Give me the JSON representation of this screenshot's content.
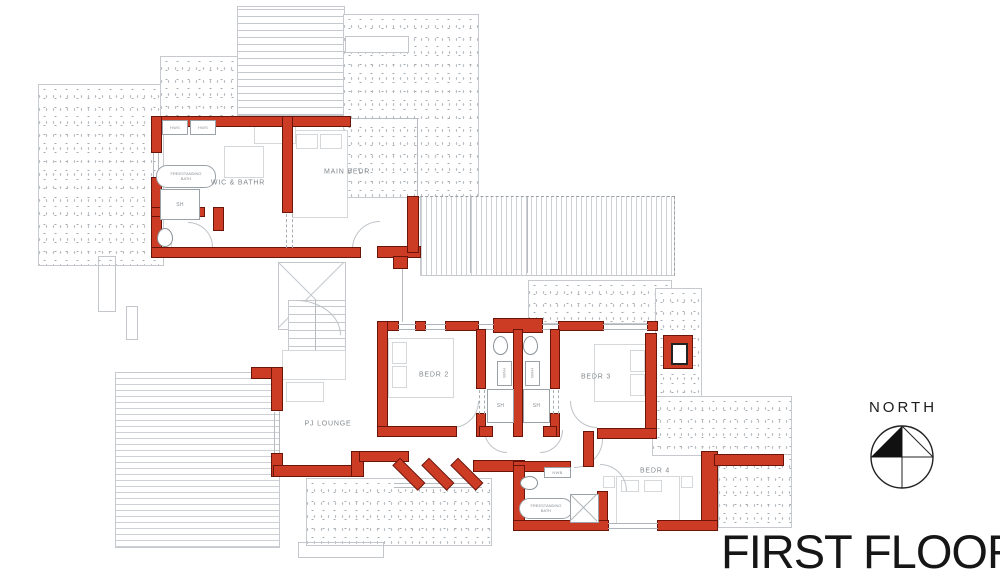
{
  "title": {
    "text": "FIRST FLOOR"
  },
  "compass": {
    "label": "NORTH"
  },
  "rooms": {
    "wic_bathr": "WIC & BATHR",
    "main_bedr": "MAIN BEDR",
    "pj_lounge": "PJ LOUNGE",
    "bedr2": "BEDR 2",
    "bedr3": "BEDR 3",
    "bedr4": "BEDR 4"
  },
  "fixtures": {
    "hws": "HWS",
    "hwb": "HWB",
    "shower": "SH",
    "freestanding_bath": "FREESTANDING\nBATH"
  },
  "colors": {
    "wall_red": "#cc3b24",
    "wall_outline": "#6b140a",
    "outline_gray": "#c3c7cb",
    "label_gray": "#82888d",
    "title_black": "#161616"
  }
}
